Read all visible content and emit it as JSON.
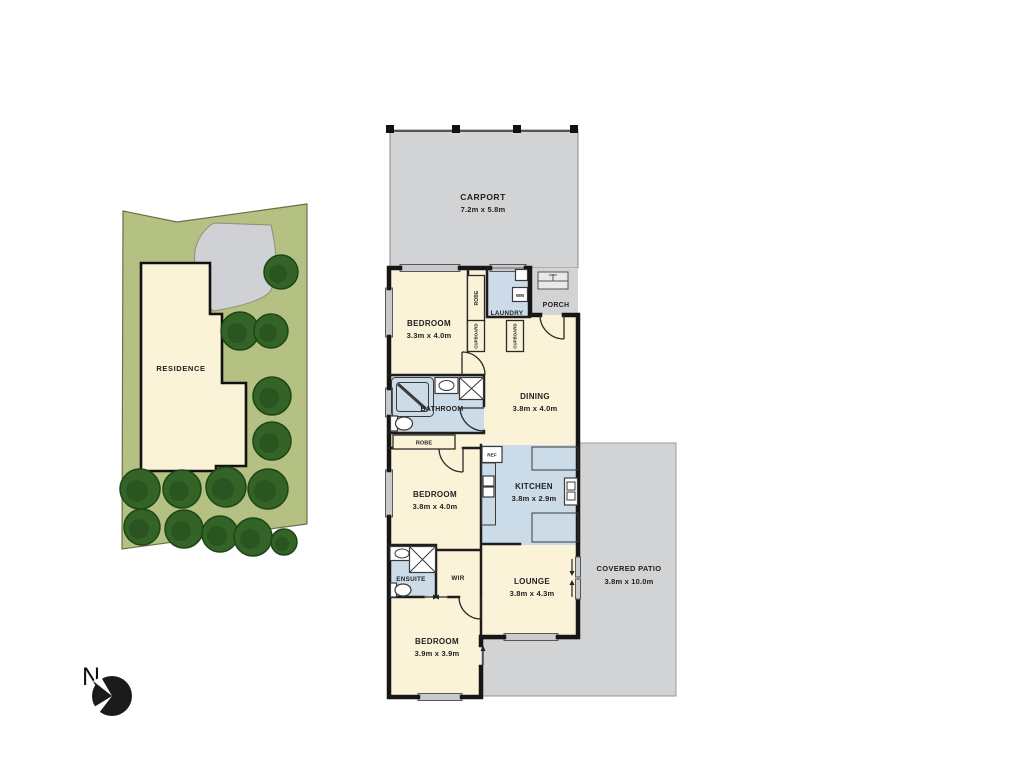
{
  "floor_plan": {
    "rooms": [
      {
        "name": "CARPORT",
        "dims": "7.2m x 5.8m"
      },
      {
        "name": "PORCH",
        "dims": ""
      },
      {
        "name": "LAUNDRY",
        "dims": ""
      },
      {
        "name": "BEDROOM",
        "dims": "3.3m x 4.0m"
      },
      {
        "name": "BATHROOM",
        "dims": ""
      },
      {
        "name": "DINING",
        "dims": "3.8m x 4.0m"
      },
      {
        "name": "BEDROOM",
        "dims": "3.8m x 4.0m"
      },
      {
        "name": "KITCHEN",
        "dims": "3.8m x 2.9m"
      },
      {
        "name": "ENSUITE",
        "dims": ""
      },
      {
        "name": "WIR",
        "dims": ""
      },
      {
        "name": "LOUNGE",
        "dims": "3.8m x 4.3m"
      },
      {
        "name": "BEDROOM",
        "dims": "3.9m x 3.9m"
      },
      {
        "name": "COVERED PATIO",
        "dims": "3.8m x 10.0m"
      }
    ],
    "fixtures": {
      "wm": "WM",
      "ref": "REF",
      "robe": "ROBE",
      "cupboard": "CUPBOARD"
    }
  },
  "site_plan": {
    "residence_label": "RESIDENCE"
  },
  "compass": {
    "north_label": "N"
  },
  "colors": {
    "room_fill": "#fbf3d8",
    "wet_area_fill": "#ccdbe8",
    "hard_surface_fill": "#d2d3d5",
    "lot_fill": "#b5c183",
    "tree_fill": "#336326",
    "wall": "#161616"
  }
}
